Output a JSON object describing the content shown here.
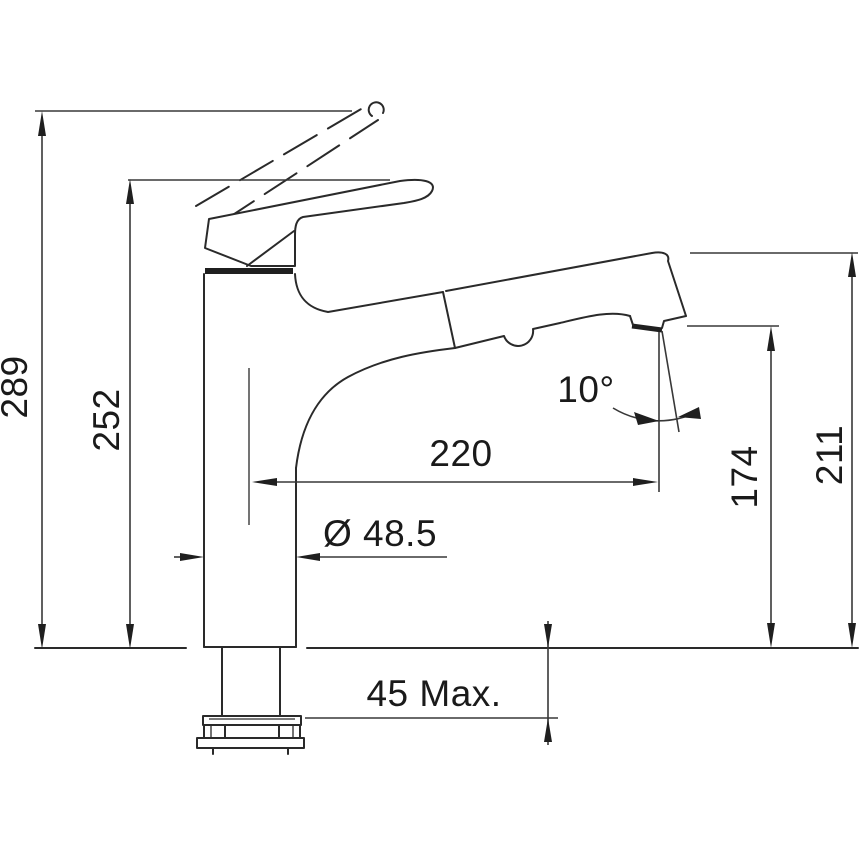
{
  "page": {
    "background": "#ffffff",
    "title": "Faucet technical dimension drawing"
  },
  "drawing": {
    "subject": "pull-out kitchen mixer tap, side elevation line drawing",
    "units": "mm",
    "line_color": "#2a2a2a",
    "text_color": "#1a1a1a",
    "labels": {
      "overall_height": "289",
      "handle_height": "252",
      "spout_reach": "220",
      "outlet_height": "174",
      "spout_height": "211",
      "spray_angle": "10°",
      "base_diameter": "Ø 48.5",
      "counter_thickness": "45 Max."
    }
  }
}
